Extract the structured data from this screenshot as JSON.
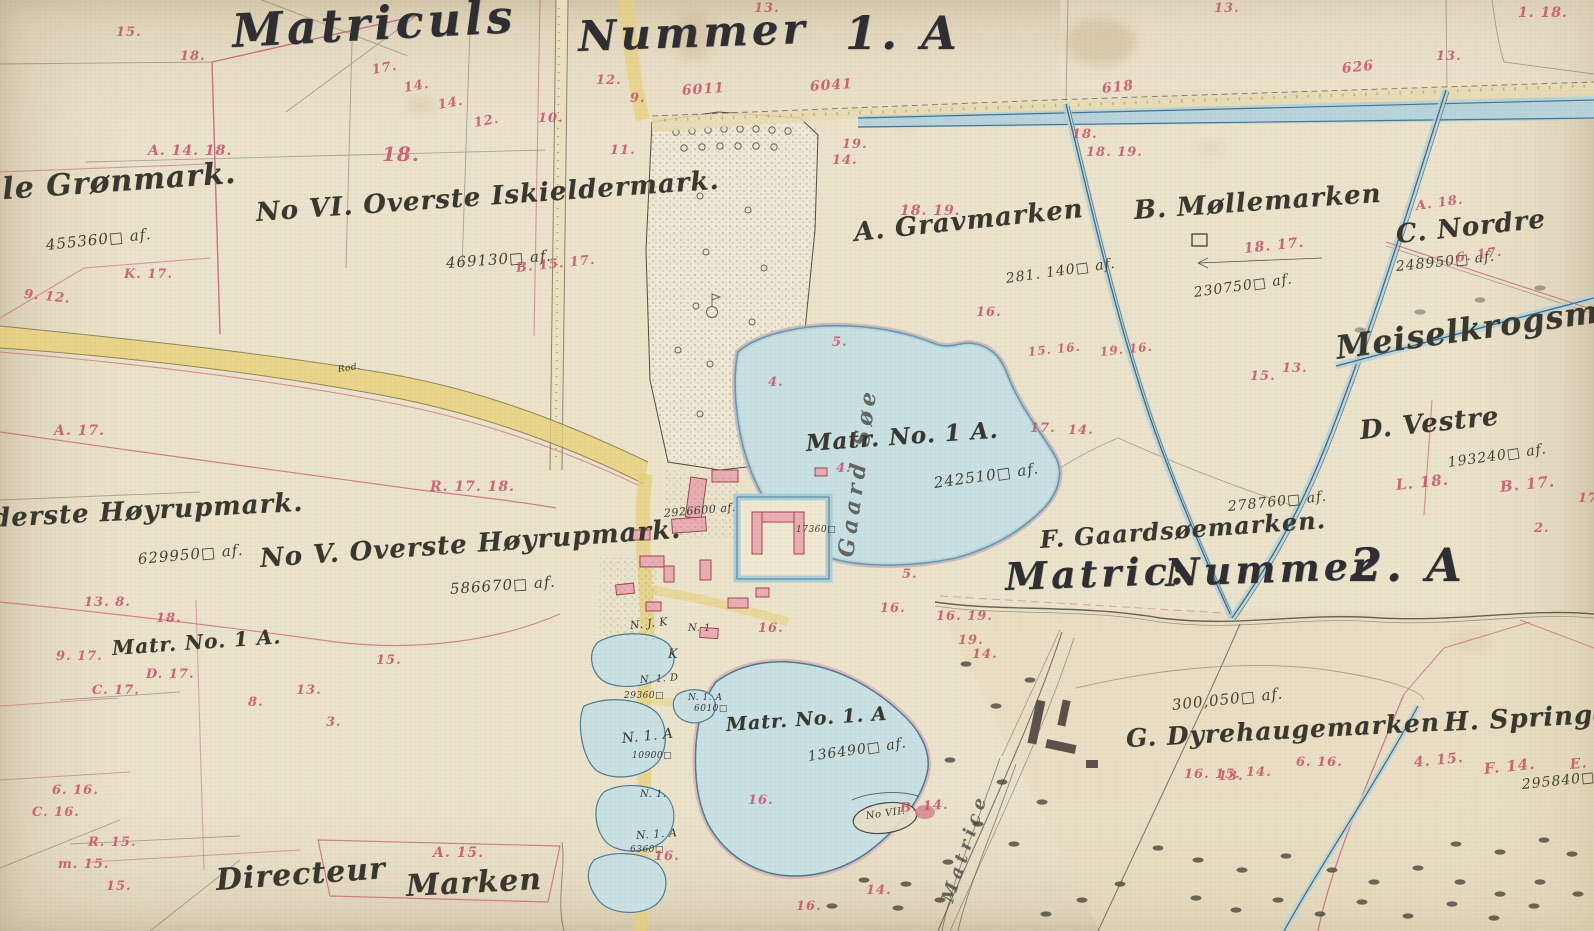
{
  "map_title": "Matriculs Nummer 1. A — historisk matrikelkort",
  "colors": {
    "ink": "#3a3a33",
    "red_numbers": "#c84a60",
    "water_fill": "#c9e0e4",
    "water_edge": "#4a7d96",
    "road_fill": "#e7d27b",
    "parchment": "#ece3cc",
    "building_fill": "#e8aeb4",
    "building_edge": "#a4454f",
    "boundary_pink": "#c4566a"
  },
  "labels": {
    "headers": [
      {
        "text": "Matriculs",
        "x": 232,
        "y": 8,
        "size": 46,
        "rot": -3
      },
      {
        "text": "Nummer",
        "x": 578,
        "y": 16,
        "size": 42,
        "rot": -2
      },
      {
        "text": "1. A",
        "x": 845,
        "y": 10,
        "size": 46,
        "rot": 0
      },
      {
        "text": "Matric:",
        "x": 1005,
        "y": 558,
        "size": 38,
        "rot": -2
      },
      {
        "text": "Nummer",
        "x": 1165,
        "y": 554,
        "size": 38,
        "rot": -2
      },
      {
        "text": "2. A",
        "x": 1350,
        "y": 542,
        "size": 46,
        "rot": 0
      }
    ],
    "names": [
      {
        "text": "lle Grønmark.",
        "x": -10,
        "y": 176,
        "size": 30,
        "rot": -4
      },
      {
        "text": "No VI. Overste Iskieldermark.",
        "x": 256,
        "y": 200,
        "size": 26,
        "rot": -4
      },
      {
        "text": "A. Gravmarken",
        "x": 854,
        "y": 220,
        "size": 26,
        "rot": -6
      },
      {
        "text": "B. Møllemarken",
        "x": 1134,
        "y": 198,
        "size": 26,
        "rot": -4
      },
      {
        "text": "C. Nordre",
        "x": 1396,
        "y": 222,
        "size": 26,
        "rot": -6
      },
      {
        "text": "Meiselkrogsmark",
        "x": 1336,
        "y": 332,
        "size": 32,
        "rot": -8
      },
      {
        "text": "D. Vestre",
        "x": 1360,
        "y": 418,
        "size": 26,
        "rot": -6
      },
      {
        "text": "Matr. No. 1 A.",
        "x": 806,
        "y": 432,
        "size": 23,
        "rot": -4
      },
      {
        "text": "F. Gaardsøemarken.",
        "x": 1040,
        "y": 528,
        "size": 24,
        "rot": -4
      },
      {
        "text": "derste Høyrupmark.",
        "x": -8,
        "y": 506,
        "size": 26,
        "rot": -3
      },
      {
        "text": "No V. Overste Høyrupmark.",
        "x": 260,
        "y": 546,
        "size": 26,
        "rot": -4
      },
      {
        "text": "Matr. No. 1 A.",
        "x": 112,
        "y": 638,
        "size": 20,
        "rot": -4
      },
      {
        "text": "Matr. No. 1. A",
        "x": 726,
        "y": 716,
        "size": 19,
        "rot": -4
      },
      {
        "text": "G. Dyrehaugemarken",
        "x": 1126,
        "y": 726,
        "size": 25,
        "rot": -3
      },
      {
        "text": "H. Springdal",
        "x": 1444,
        "y": 710,
        "size": 26,
        "rot": -3
      },
      {
        "text": "Directeur",
        "x": 216,
        "y": 866,
        "size": 30,
        "rot": -4
      },
      {
        "text": "Marken",
        "x": 406,
        "y": 872,
        "size": 30,
        "rot": -3
      }
    ],
    "areas": [
      {
        "text": "455360□ af.",
        "x": 46,
        "y": 238,
        "size": 15,
        "rot": -6
      },
      {
        "text": "469130□ af.",
        "x": 446,
        "y": 256,
        "size": 15,
        "rot": -4
      },
      {
        "text": "281. 140□ af.",
        "x": 1006,
        "y": 272,
        "size": 14,
        "rot": -8
      },
      {
        "text": "230750□ af.",
        "x": 1194,
        "y": 286,
        "size": 14,
        "rot": -8
      },
      {
        "text": "248950□ af.",
        "x": 1396,
        "y": 260,
        "size": 14,
        "rot": -6
      },
      {
        "text": "193240□ af.",
        "x": 1448,
        "y": 456,
        "size": 14,
        "rot": -8
      },
      {
        "text": "242510□ af.",
        "x": 934,
        "y": 476,
        "size": 15,
        "rot": -8
      },
      {
        "text": "278760□ af.",
        "x": 1228,
        "y": 500,
        "size": 14,
        "rot": -6
      },
      {
        "text": "629950□ af.",
        "x": 138,
        "y": 552,
        "size": 15,
        "rot": -5
      },
      {
        "text": "586670□ af.",
        "x": 450,
        "y": 582,
        "size": 15,
        "rot": -4
      },
      {
        "text": "136490□ af.",
        "x": 808,
        "y": 750,
        "size": 14,
        "rot": -8
      },
      {
        "text": "300,050□ af.",
        "x": 1172,
        "y": 698,
        "size": 15,
        "rot": -6
      },
      {
        "text": "295840□ af.",
        "x": 1522,
        "y": 778,
        "size": 14,
        "rot": -6
      }
    ],
    "small": [
      {
        "text": "2926600 af.",
        "x": 664,
        "y": 508,
        "size": 11,
        "rot": -5
      },
      {
        "text": "17360□",
        "x": 796,
        "y": 526,
        "size": 9,
        "rot": 0
      },
      {
        "text": "N. J. K",
        "x": 630,
        "y": 620,
        "size": 11,
        "rot": -6
      },
      {
        "text": "N. 1",
        "x": 688,
        "y": 624,
        "size": 10,
        "rot": 0
      },
      {
        "text": "K",
        "x": 668,
        "y": 648,
        "size": 13,
        "rot": 0
      },
      {
        "text": "N. 1. D",
        "x": 640,
        "y": 676,
        "size": 10,
        "rot": -4
      },
      {
        "text": "29360□",
        "x": 624,
        "y": 692,
        "size": 9,
        "rot": 0
      },
      {
        "text": "N. 1. A",
        "x": 688,
        "y": 694,
        "size": 9,
        "rot": 0
      },
      {
        "text": "6010□",
        "x": 694,
        "y": 705,
        "size": 9,
        "rot": 0
      },
      {
        "text": "N. 1. A",
        "x": 622,
        "y": 732,
        "size": 14,
        "rot": -6
      },
      {
        "text": "10900□",
        "x": 632,
        "y": 752,
        "size": 9,
        "rot": 0
      },
      {
        "text": "N. 1.",
        "x": 640,
        "y": 790,
        "size": 10,
        "rot": 0
      },
      {
        "text": "N. 1. A",
        "x": 636,
        "y": 830,
        "size": 11,
        "rot": -4
      },
      {
        "text": "6360□",
        "x": 630,
        "y": 846,
        "size": 9,
        "rot": 0
      },
      {
        "text": "Rod.",
        "x": 338,
        "y": 366,
        "size": 9,
        "rot": -8
      },
      {
        "text": "No VII.",
        "x": 866,
        "y": 812,
        "size": 10,
        "rot": -8
      }
    ],
    "vertical": [
      {
        "text": "Gaard Søe",
        "x": 846,
        "y": 546,
        "size": 22,
        "rot": -82
      },
      {
        "text": "Matrice",
        "x": 948,
        "y": 893,
        "size": 18,
        "rot": -72
      }
    ],
    "red_marks": [
      {
        "text": "15.",
        "x": 116,
        "y": 26
      },
      {
        "text": "18.",
        "x": 180,
        "y": 50
      },
      {
        "text": "17.",
        "x": 372,
        "y": 64,
        "rot": -10
      },
      {
        "text": "14.",
        "x": 404,
        "y": 82,
        "rot": -10
      },
      {
        "text": "14.",
        "x": 438,
        "y": 99,
        "rot": -10
      },
      {
        "text": "12.",
        "x": 474,
        "y": 117,
        "rot": -10
      },
      {
        "text": "A. 14. 18.",
        "x": 148,
        "y": 144,
        "size": 14
      },
      {
        "text": "18.",
        "x": 382,
        "y": 144,
        "size": 20
      },
      {
        "text": "10.",
        "x": 538,
        "y": 112
      },
      {
        "text": "12.",
        "x": 596,
        "y": 74
      },
      {
        "text": "11.",
        "x": 610,
        "y": 144
      },
      {
        "text": "9.",
        "x": 630,
        "y": 92
      },
      {
        "text": "9. 12.",
        "x": 24,
        "y": 288,
        "rot": 6
      },
      {
        "text": "K. 17.",
        "x": 124,
        "y": 268
      },
      {
        "text": "B. 15. 17.",
        "x": 516,
        "y": 262,
        "rot": -6
      },
      {
        "text": "6011",
        "x": 682,
        "y": 84,
        "size": 14,
        "rot": -4
      },
      {
        "text": "6041",
        "x": 810,
        "y": 80,
        "size": 14,
        "rot": -4
      },
      {
        "text": "618",
        "x": 1102,
        "y": 82,
        "size": 14,
        "rot": -6
      },
      {
        "text": "626",
        "x": 1342,
        "y": 62,
        "size": 14,
        "rot": -6
      },
      {
        "text": "13.",
        "x": 754,
        "y": 2
      },
      {
        "text": "13.",
        "x": 1214,
        "y": 2
      },
      {
        "text": "1. 18.",
        "x": 1518,
        "y": 6,
        "size": 14
      },
      {
        "text": "19.",
        "x": 842,
        "y": 138
      },
      {
        "text": "14.",
        "x": 832,
        "y": 154
      },
      {
        "text": "18. 19.",
        "x": 900,
        "y": 204,
        "size": 14
      },
      {
        "text": "18.",
        "x": 1072,
        "y": 128
      },
      {
        "text": "18. 19.",
        "x": 1086,
        "y": 146
      },
      {
        "text": "18. 17.",
        "x": 1244,
        "y": 242,
        "size": 14,
        "rot": -6
      },
      {
        "text": "13.",
        "x": 1436,
        "y": 50
      },
      {
        "text": "A. 18.",
        "x": 1416,
        "y": 200,
        "rot": -8
      },
      {
        "text": "6. 17.",
        "x": 1456,
        "y": 252,
        "rot": -8
      },
      {
        "text": "L. 18.",
        "x": 1396,
        "y": 478,
        "size": 15,
        "rot": -6
      },
      {
        "text": "B. 17.",
        "x": 1500,
        "y": 480,
        "size": 15,
        "rot": -6
      },
      {
        "text": "17.",
        "x": 1578,
        "y": 492
      },
      {
        "text": "2.",
        "x": 1534,
        "y": 522
      },
      {
        "text": "5.",
        "x": 832,
        "y": 336
      },
      {
        "text": "4.",
        "x": 768,
        "y": 376
      },
      {
        "text": "16.",
        "x": 976,
        "y": 306
      },
      {
        "text": "15. 16.",
        "x": 1028,
        "y": 346,
        "size": 12,
        "rot": -6
      },
      {
        "text": "19. 16.",
        "x": 1100,
        "y": 346,
        "size": 12,
        "rot": -6
      },
      {
        "text": "17.",
        "x": 1030,
        "y": 422
      },
      {
        "text": "14.",
        "x": 1068,
        "y": 424
      },
      {
        "text": "15.",
        "x": 1250,
        "y": 370
      },
      {
        "text": "13.",
        "x": 1282,
        "y": 362
      },
      {
        "text": "4.",
        "x": 836,
        "y": 462
      },
      {
        "text": "5.",
        "x": 902,
        "y": 568
      },
      {
        "text": "16.",
        "x": 758,
        "y": 622
      },
      {
        "text": "16.",
        "x": 880,
        "y": 602
      },
      {
        "text": "16. 19.",
        "x": 936,
        "y": 610
      },
      {
        "text": "19.",
        "x": 958,
        "y": 634
      },
      {
        "text": "14.",
        "x": 972,
        "y": 648
      },
      {
        "text": "16. 15.",
        "x": 1184,
        "y": 768
      },
      {
        "text": "13.",
        "x": 1218,
        "y": 770
      },
      {
        "text": "14.",
        "x": 1246,
        "y": 766
      },
      {
        "text": "6. 16.",
        "x": 1296,
        "y": 756
      },
      {
        "text": "4. 15.",
        "x": 1414,
        "y": 756,
        "size": 14,
        "rot": -6
      },
      {
        "text": "F. 14.",
        "x": 1484,
        "y": 762,
        "size": 15,
        "rot": -6
      },
      {
        "text": "E. 14.",
        "x": 1570,
        "y": 758,
        "size": 14,
        "rot": -6
      },
      {
        "text": "16.",
        "x": 748,
        "y": 794
      },
      {
        "text": "16.",
        "x": 654,
        "y": 850
      },
      {
        "text": "B. 14.",
        "x": 900,
        "y": 802,
        "rot": -4
      },
      {
        "text": "14.",
        "x": 866,
        "y": 884
      },
      {
        "text": "16.",
        "x": 796,
        "y": 900
      },
      {
        "text": "A. 15.",
        "x": 433,
        "y": 846,
        "size": 14
      },
      {
        "text": "6. 16.",
        "x": 52,
        "y": 784
      },
      {
        "text": "C. 16.",
        "x": 32,
        "y": 806
      },
      {
        "text": "R. 15.",
        "x": 88,
        "y": 836
      },
      {
        "text": "m. 15.",
        "x": 58,
        "y": 858
      },
      {
        "text": "15.",
        "x": 106,
        "y": 880
      },
      {
        "text": "13. 8.",
        "x": 84,
        "y": 596
      },
      {
        "text": "18.",
        "x": 156,
        "y": 612
      },
      {
        "text": "9. 17.",
        "x": 56,
        "y": 650
      },
      {
        "text": "C. 17.",
        "x": 92,
        "y": 684
      },
      {
        "text": "D. 17.",
        "x": 146,
        "y": 668
      },
      {
        "text": "15.",
        "x": 376,
        "y": 654
      },
      {
        "text": "13.",
        "x": 296,
        "y": 684
      },
      {
        "text": "8.",
        "x": 248,
        "y": 696
      },
      {
        "text": "3.",
        "x": 326,
        "y": 716
      },
      {
        "text": "R. 17. 18.",
        "x": 430,
        "y": 480,
        "size": 14
      },
      {
        "text": "A. 17.",
        "x": 54,
        "y": 424,
        "size": 14
      }
    ]
  }
}
